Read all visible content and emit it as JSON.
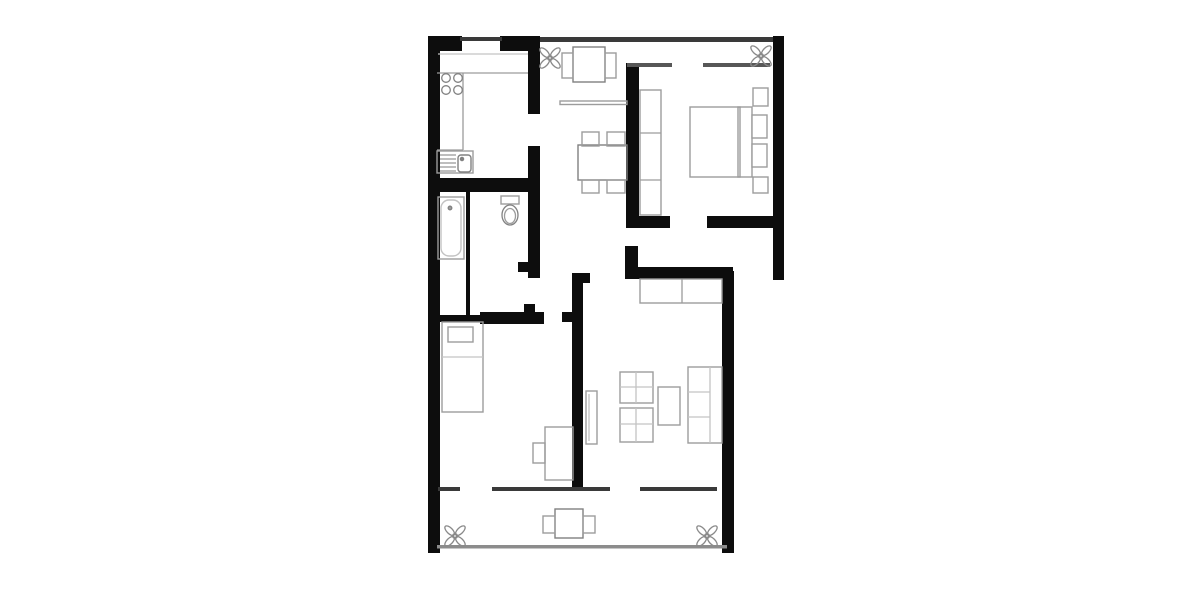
{
  "canvas": {
    "width": 1200,
    "height": 600,
    "background": "#ffffff"
  },
  "palette": {
    "wall": "#0d0d0d",
    "thin": "#3a3a3a",
    "window": "#575757",
    "railing": "#8c8c8c",
    "furniture": "#9c9c9c",
    "dark": "#818181",
    "light": "#c3c3c3",
    "plant": "#8a8a8a",
    "floor": "#ffffff"
  },
  "floorplan": {
    "walls": [
      {
        "name": "wall-left-exterior",
        "x": 428,
        "y": 38,
        "w": 12,
        "h": 515
      },
      {
        "name": "wall-top-left",
        "x": 428,
        "y": 36,
        "w": 34,
        "h": 15
      },
      {
        "name": "wall-top-right-of-door",
        "x": 500,
        "y": 36,
        "w": 33,
        "h": 15
      },
      {
        "name": "wall-kitchen-east-upper",
        "x": 528,
        "y": 36,
        "w": 12,
        "h": 78
      },
      {
        "name": "wall-kitchen-east-lower",
        "x": 528,
        "y": 146,
        "w": 12,
        "h": 132
      },
      {
        "name": "wall-bath-door-jamb-n",
        "x": 518,
        "y": 262,
        "w": 10,
        "h": 10
      },
      {
        "name": "wall-kitchen-south",
        "x": 428,
        "y": 178,
        "w": 102,
        "h": 14
      },
      {
        "name": "wall-bath-partition",
        "x": 466,
        "y": 192,
        "w": 4,
        "h": 126
      },
      {
        "name": "wall-bath-south-a",
        "x": 428,
        "y": 315,
        "w": 56,
        "h": 7
      },
      {
        "name": "wall-bath-south-b",
        "x": 480,
        "y": 312,
        "w": 64,
        "h": 12
      },
      {
        "name": "wall-bath-door-jamb-s",
        "x": 524,
        "y": 304,
        "w": 11,
        "h": 9
      },
      {
        "name": "wall-hall-stub",
        "x": 562,
        "y": 312,
        "w": 10,
        "h": 10
      },
      {
        "name": "wall-living-west",
        "x": 572,
        "y": 273,
        "w": 11,
        "h": 217
      },
      {
        "name": "wall-living-west-head",
        "x": 572,
        "y": 273,
        "w": 18,
        "h": 10
      },
      {
        "name": "wall-living-north",
        "x": 625,
        "y": 267,
        "w": 108,
        "h": 12
      },
      {
        "name": "wall-living-north-stub",
        "x": 625,
        "y": 246,
        "w": 13,
        "h": 22
      },
      {
        "name": "wall-bedroom-west",
        "x": 626,
        "y": 63,
        "w": 13,
        "h": 165
      },
      {
        "name": "wall-bedroom-south-a",
        "x": 626,
        "y": 216,
        "w": 44,
        "h": 12
      },
      {
        "name": "wall-bedroom-south-b",
        "x": 707,
        "y": 216,
        "w": 68,
        "h": 12
      },
      {
        "name": "wall-right-exterior",
        "x": 773,
        "y": 36,
        "w": 11,
        "h": 244
      },
      {
        "name": "wall-living-east",
        "x": 722,
        "y": 271,
        "w": 12,
        "h": 282
      }
    ],
    "thin_walls": [
      {
        "name": "entrance-door-line",
        "x": 460,
        "y": 37,
        "w": 42,
        "h": 4,
        "tone": "thin"
      },
      {
        "name": "window-band-top",
        "x": 540,
        "y": 37,
        "w": 233,
        "h": 5,
        "tone": "thin"
      },
      {
        "name": "bedroom-window-west",
        "x": 627,
        "y": 63,
        "w": 45,
        "h": 4,
        "tone": "window"
      },
      {
        "name": "bedroom-window-east",
        "x": 703,
        "y": 63,
        "w": 67,
        "h": 4,
        "tone": "window"
      },
      {
        "name": "balcony-window-a",
        "x": 438,
        "y": 487,
        "w": 22,
        "h": 4,
        "tone": "thin"
      },
      {
        "name": "balcony-window-b",
        "x": 492,
        "y": 487,
        "w": 118,
        "h": 4,
        "tone": "thin"
      },
      {
        "name": "balcony-window-c",
        "x": 640,
        "y": 487,
        "w": 77,
        "h": 4,
        "tone": "thin"
      },
      {
        "name": "balcony-railing",
        "x": 437,
        "y": 545,
        "w": 290,
        "h": 3.5,
        "tone": "railing"
      }
    ],
    "furniture": [
      {
        "name": "kitchen-sink-unit",
        "x": 437,
        "y": 151,
        "w": 36,
        "h": 22,
        "tone": "furniture"
      },
      {
        "name": "kitchen-sink-basin",
        "x": 458,
        "y": 155,
        "w": 13,
        "h": 17,
        "rx": 3,
        "tone": "dark",
        "fill": "#ffffff"
      },
      {
        "name": "bathtub",
        "x": 438,
        "y": 197,
        "w": 26,
        "h": 62,
        "tone": "furniture"
      },
      {
        "name": "bathtub-inner",
        "x": 441,
        "y": 200,
        "w": 20,
        "h": 56,
        "rx": 8,
        "tone": "light"
      },
      {
        "name": "toilet-tank",
        "x": 501,
        "y": 196,
        "w": 18,
        "h": 8,
        "tone": "furniture"
      },
      {
        "name": "child-bed",
        "x": 442,
        "y": 322,
        "w": 41,
        "h": 90,
        "tone": "furniture"
      },
      {
        "name": "child-bed-pillow",
        "x": 448,
        "y": 327,
        "w": 25,
        "h": 15,
        "tone": "furniture",
        "fill": "#ffffff"
      },
      {
        "name": "child-desk",
        "x": 545,
        "y": 427,
        "w": 28,
        "h": 53,
        "tone": "furniture"
      },
      {
        "name": "child-desk-chair",
        "x": 533,
        "y": 443,
        "w": 12,
        "h": 20,
        "tone": "furniture"
      },
      {
        "name": "living-radiator",
        "x": 586,
        "y": 391,
        "w": 11,
        "h": 53,
        "tone": "furniture"
      },
      {
        "name": "living-sideboard",
        "x": 640,
        "y": 279,
        "w": 82,
        "h": 24,
        "tone": "furniture"
      },
      {
        "name": "living-armchair-1",
        "x": 620,
        "y": 372,
        "w": 33,
        "h": 31,
        "tone": "furniture"
      },
      {
        "name": "living-armchair-2",
        "x": 620,
        "y": 408,
        "w": 33,
        "h": 34,
        "tone": "furniture"
      },
      {
        "name": "living-coffee-table",
        "x": 658,
        "y": 387,
        "w": 22,
        "h": 38,
        "tone": "furniture"
      },
      {
        "name": "living-sofa",
        "x": 688,
        "y": 367,
        "w": 34,
        "h": 76,
        "tone": "furniture"
      },
      {
        "name": "balcony-table",
        "x": 555,
        "y": 509,
        "w": 28,
        "h": 29,
        "tone": "dark"
      },
      {
        "name": "balcony-chair-left",
        "x": 543,
        "y": 516,
        "w": 12,
        "h": 17,
        "tone": "furniture"
      },
      {
        "name": "balcony-chair-right",
        "x": 583,
        "y": 516,
        "w": 12,
        "h": 17,
        "tone": "furniture"
      },
      {
        "name": "breakfast-table",
        "x": 573,
        "y": 47,
        "w": 32,
        "h": 35,
        "tone": "dark"
      },
      {
        "name": "breakfast-chair-left",
        "x": 562,
        "y": 53,
        "w": 11,
        "h": 25,
        "tone": "furniture"
      },
      {
        "name": "breakfast-chair-right",
        "x": 605,
        "y": 53,
        "w": 11,
        "h": 25,
        "tone": "furniture"
      },
      {
        "name": "wall-shelf",
        "x": 560,
        "y": 101,
        "w": 67,
        "h": 3.5,
        "tone": "furniture"
      },
      {
        "name": "dining-table",
        "x": 578,
        "y": 145,
        "w": 49,
        "h": 35,
        "tone": "dark"
      },
      {
        "name": "dining-chair-nw",
        "x": 582,
        "y": 132,
        "w": 17,
        "h": 14,
        "tone": "furniture"
      },
      {
        "name": "dining-chair-ne",
        "x": 607,
        "y": 132,
        "w": 18,
        "h": 14,
        "tone": "furniture"
      },
      {
        "name": "dining-chair-sw",
        "x": 582,
        "y": 180,
        "w": 17,
        "h": 13,
        "tone": "furniture"
      },
      {
        "name": "dining-chair-se",
        "x": 607,
        "y": 180,
        "w": 18,
        "h": 13,
        "tone": "furniture"
      },
      {
        "name": "bedroom-wardrobe",
        "x": 640,
        "y": 90,
        "w": 21,
        "h": 125,
        "tone": "furniture"
      },
      {
        "name": "bedroom-bed",
        "x": 690,
        "y": 107,
        "w": 50,
        "h": 70,
        "tone": "furniture"
      },
      {
        "name": "bedroom-headboard",
        "x": 738,
        "y": 107,
        "w": 14,
        "h": 70,
        "tone": "furniture"
      },
      {
        "name": "bedroom-pillow-1",
        "x": 752,
        "y": 115,
        "w": 15,
        "h": 23,
        "tone": "furniture",
        "fill": "#ffffff"
      },
      {
        "name": "bedroom-pillow-2",
        "x": 752,
        "y": 144,
        "w": 15,
        "h": 23,
        "tone": "furniture",
        "fill": "#ffffff"
      },
      {
        "name": "bedroom-nightstand-1",
        "x": 753,
        "y": 88,
        "w": 15,
        "h": 18,
        "tone": "furniture"
      },
      {
        "name": "bedroom-nightstand-2",
        "x": 753,
        "y": 177,
        "w": 15,
        "h": 16,
        "tone": "furniture"
      }
    ],
    "lines": [
      {
        "name": "kitchen-inner-top-line",
        "x1": 438,
        "y1": 54,
        "x2": 528,
        "y2": 54,
        "tone": "light"
      },
      {
        "name": "kitchen-counter-top",
        "x1": 437,
        "y1": 73,
        "x2": 528,
        "y2": 73,
        "tone": "furniture"
      },
      {
        "name": "kitchen-counter-edge",
        "x1": 463,
        "y1": 73,
        "x2": 463,
        "y2": 150,
        "tone": "furniture"
      },
      {
        "name": "kitchen-counter-bottom",
        "x1": 437,
        "y1": 150,
        "x2": 463,
        "y2": 150,
        "tone": "furniture"
      },
      {
        "name": "sink-drainer-line-1",
        "x1": 440,
        "y1": 155,
        "x2": 456,
        "y2": 155,
        "tone": "furniture"
      },
      {
        "name": "sink-drainer-line-2",
        "x1": 440,
        "y1": 159,
        "x2": 456,
        "y2": 159,
        "tone": "furniture"
      },
      {
        "name": "sink-drainer-line-3",
        "x1": 440,
        "y1": 163,
        "x2": 456,
        "y2": 163,
        "tone": "furniture"
      },
      {
        "name": "sink-drainer-line-4",
        "x1": 440,
        "y1": 167,
        "x2": 456,
        "y2": 167,
        "tone": "furniture"
      },
      {
        "name": "sink-drainer-line-5",
        "x1": 440,
        "y1": 171,
        "x2": 456,
        "y2": 171,
        "tone": "furniture"
      },
      {
        "name": "child-bed-blanket-line",
        "x1": 442,
        "y1": 357,
        "x2": 483,
        "y2": 357,
        "tone": "light"
      },
      {
        "name": "radiator-inner-line",
        "x1": 589,
        "y1": 394,
        "x2": 589,
        "y2": 441,
        "tone": "light"
      },
      {
        "name": "sideboard-divider",
        "x1": 682,
        "y1": 279,
        "x2": 682,
        "y2": 303,
        "tone": "furniture"
      },
      {
        "name": "armchair-1-line-v",
        "x1": 636,
        "y1": 372,
        "x2": 636,
        "y2": 403,
        "tone": "light"
      },
      {
        "name": "armchair-1-line-h",
        "x1": 620,
        "y1": 387,
        "x2": 653,
        "y2": 387,
        "tone": "light"
      },
      {
        "name": "armchair-2-line-v",
        "x1": 636,
        "y1": 408,
        "x2": 636,
        "y2": 442,
        "tone": "light"
      },
      {
        "name": "armchair-2-line-h",
        "x1": 620,
        "y1": 424,
        "x2": 653,
        "y2": 424,
        "tone": "light"
      },
      {
        "name": "sofa-back-line",
        "x1": 710,
        "y1": 367,
        "x2": 710,
        "y2": 443,
        "tone": "light"
      },
      {
        "name": "sofa-cushion-line-1",
        "x1": 688,
        "y1": 392,
        "x2": 710,
        "y2": 392,
        "tone": "light"
      },
      {
        "name": "sofa-cushion-line-2",
        "x1": 688,
        "y1": 417,
        "x2": 710,
        "y2": 417,
        "tone": "light"
      },
      {
        "name": "wardrobe-divider-1",
        "x1": 640,
        "y1": 133,
        "x2": 661,
        "y2": 133,
        "tone": "furniture"
      },
      {
        "name": "wardrobe-divider-2",
        "x1": 640,
        "y1": 180,
        "x2": 661,
        "y2": 180,
        "tone": "furniture"
      }
    ],
    "circles": [
      {
        "name": "stove-burner-1",
        "cx": 446,
        "cy": 78,
        "r": 4.3,
        "tone": "dark"
      },
      {
        "name": "stove-burner-2",
        "cx": 458,
        "cy": 78,
        "r": 4.3,
        "tone": "dark"
      },
      {
        "name": "stove-burner-3",
        "cx": 446,
        "cy": 90,
        "r": 4.3,
        "tone": "dark"
      },
      {
        "name": "stove-burner-4",
        "cx": 458,
        "cy": 90,
        "r": 4.3,
        "tone": "dark"
      },
      {
        "name": "sink-faucet-dot",
        "cx": 462,
        "cy": 159,
        "r": 1.6,
        "tone": "dark",
        "fill": "#818181"
      },
      {
        "name": "bathtub-drain-dot",
        "cx": 450,
        "cy": 208,
        "r": 1.8,
        "tone": "dark",
        "fill": "#9c9c9c"
      }
    ],
    "ellipses": [
      {
        "name": "toilet-bowl",
        "cx": 510,
        "cy": 215,
        "rx": 8,
        "ry": 10,
        "tone": "dark"
      },
      {
        "name": "toilet-bowl-inner",
        "cx": 510,
        "cy": 216,
        "rx": 5.5,
        "ry": 7.5,
        "tone": "furniture"
      }
    ],
    "plants": [
      {
        "name": "plant-dining",
        "cx": 550,
        "cy": 58
      },
      {
        "name": "plant-bedroom",
        "cx": 761,
        "cy": 56
      },
      {
        "name": "plant-balcony-left",
        "cx": 455,
        "cy": 536
      },
      {
        "name": "plant-balcony-right",
        "cx": 707,
        "cy": 536
      }
    ]
  }
}
